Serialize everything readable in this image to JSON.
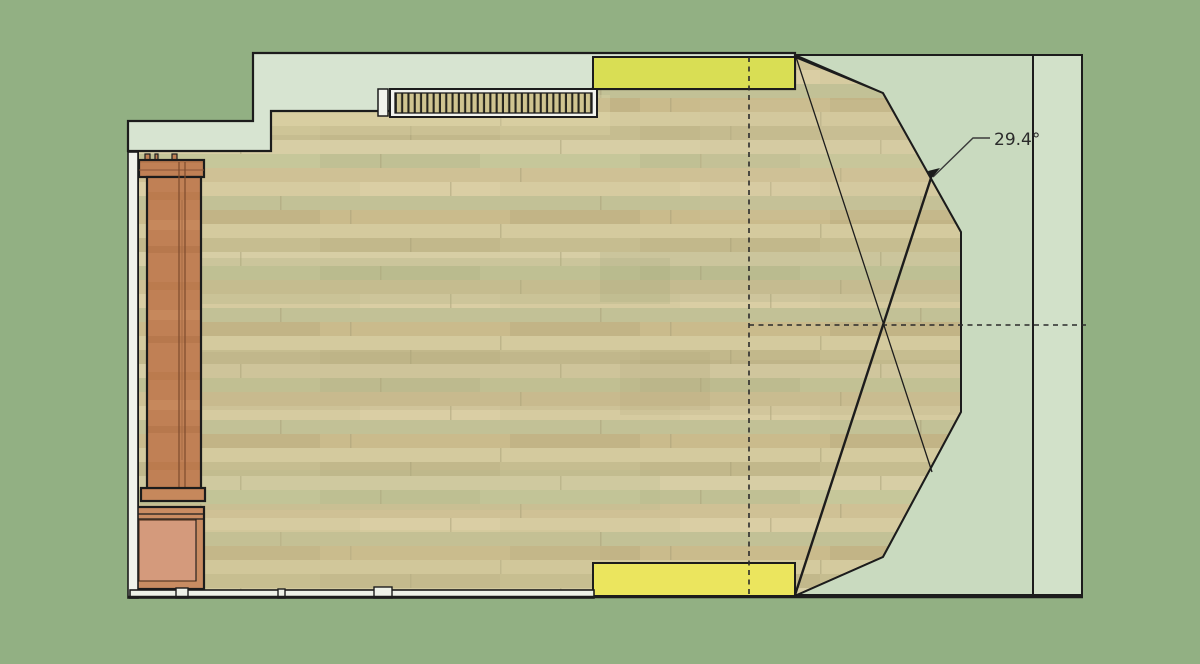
{
  "canvas": {
    "width": 1200,
    "height": 664
  },
  "annotation": {
    "angle_label": "29.4°"
  },
  "colors": {
    "background": "#92b083",
    "wall": "#d7e4d1",
    "wall_cut_white": "#f1f3ec",
    "bay_floor": "#c9dabf",
    "right_strip": "#d2e1c9",
    "outline": "#1c1c1c",
    "panel_yellow_top": "#d9de54",
    "panel_yellow_bottom": "#ebe55e",
    "floor_base": "#cdc399",
    "bench_wood": "#c08055",
    "bench_panel": "#d49a7c",
    "dash_line": "#2a2a2a"
  }
}
